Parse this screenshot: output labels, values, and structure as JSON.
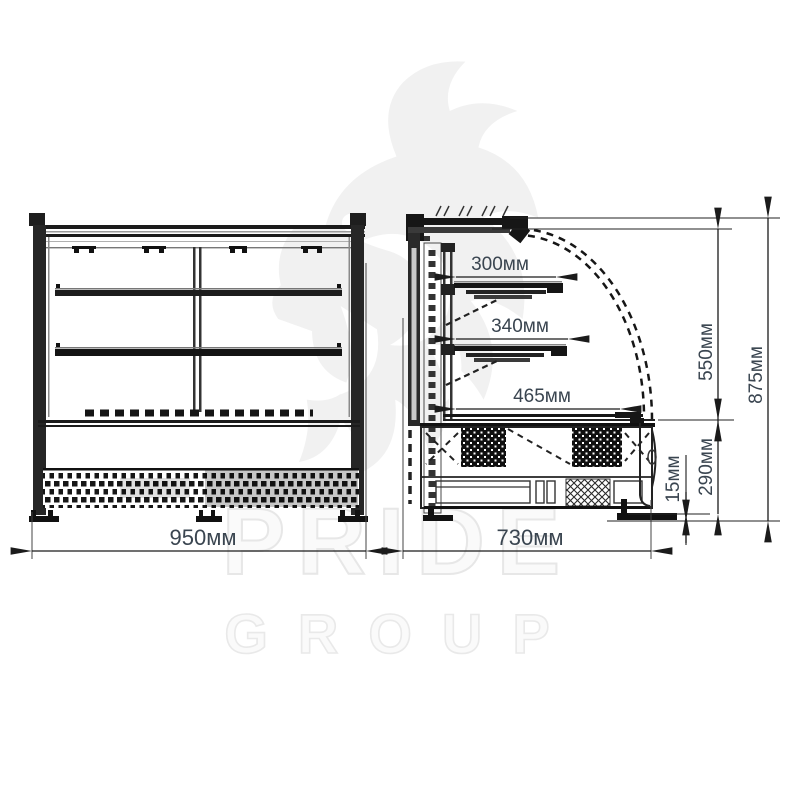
{
  "watermark": {
    "brand_line1": "PRIDE",
    "brand_line2": "GROUP",
    "logo": "lion-head"
  },
  "front_view": {
    "width": "950мм"
  },
  "side_view": {
    "depth": "730мм",
    "shelf_top_depth": "300мм",
    "shelf_middle_depth": "340мм",
    "well_depth": "465мм",
    "display_chamber_height": "550мм",
    "overall_height": "875мм",
    "base_height": "290мм",
    "foot_height": "15мм"
  },
  "colors": {
    "line": "#1b1b1b",
    "dim_text": "#3a4550",
    "watermark": "#f0f0f0"
  }
}
